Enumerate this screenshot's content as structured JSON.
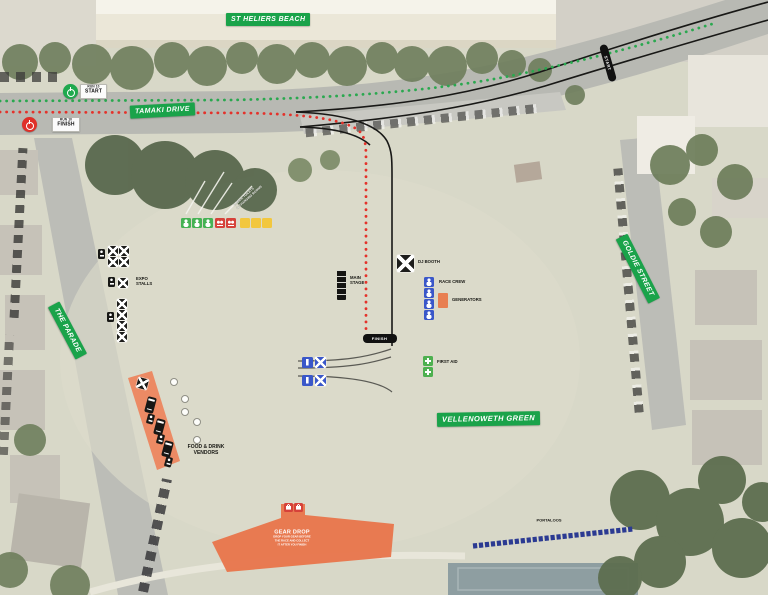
{
  "streets": {
    "st_heliers_beach": "ST HELIERS BEACH",
    "tamaki_drive": "TAMAKI DRIVE",
    "the_parade": "THE PARADE",
    "goldie_street": "GOLDIE STREET",
    "vellenoweth_green": "VELLENOWETH GREEN"
  },
  "route": {
    "start_marker": {
      "sub": "RUN 10",
      "label": "START"
    },
    "finish_marker": {
      "sub": "RUN 10",
      "label": "FINISH"
    },
    "start_line_label": "START",
    "finish_line_label": "FINISH",
    "green_route_color": "#2aa84f",
    "red_route_color": "#e4322b"
  },
  "pois": {
    "expo_stalls": {
      "label_line1": "EXPO",
      "label_line2": "STALLS",
      "tents_top_grid": 4,
      "tents_mid": 1,
      "tents_bottom_column": 4
    },
    "main_stage": {
      "label_line1": "MAIN",
      "label_line2": "STAGE"
    },
    "dj_booth": {
      "label": "DJ BOOTH"
    },
    "race_crew": {
      "label": "RACE CREW",
      "count": 4
    },
    "generators": {
      "label": "GENERATORS"
    },
    "first_aid": {
      "label": "FIRST AID",
      "count": 2
    },
    "food_vendors": {
      "label_line1": "FOOD & DRINK",
      "label_line2": "VENDORS",
      "trucks": 3,
      "carts": 3
    },
    "gear_drop": {
      "title": "GEAR DROP",
      "note_line1": "DROP YOUR GEAR BEFORE",
      "note_line2": "THE RACE AND COLLECT",
      "note_line3": "IT AFTER YOU FINISH"
    },
    "portaloos": {
      "label": "PORTALOOS",
      "count": 28
    },
    "tree_note_line1": "PUBLIC TOILETS",
    "tree_note_line2": "& CHANGING ROOMS",
    "legend_squares": {
      "green_count": 3,
      "red_count": 2,
      "yellow_count": 3
    }
  },
  "colors": {
    "street_label_bg": "#1aa34a",
    "zone_orange": "#ec8660",
    "icon_blue": "#3a57c9",
    "icon_navy": "#2b3a92",
    "icon_red": "#d6423a",
    "icon_yellow": "#f2c73e",
    "icon_green": "#46b254",
    "icon_black": "#1d1d1b"
  }
}
